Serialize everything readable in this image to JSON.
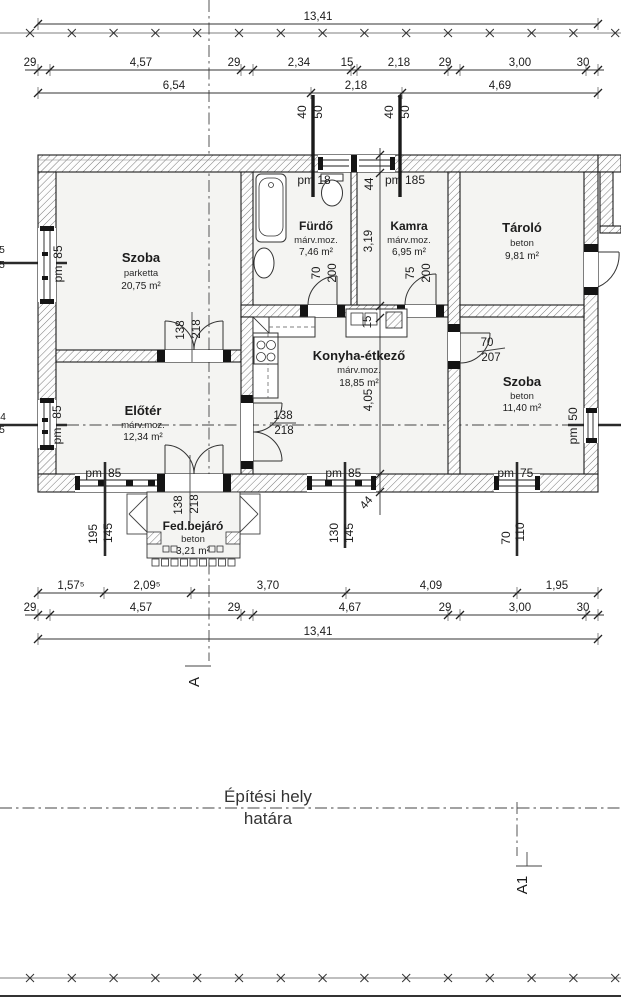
{
  "rooms": {
    "szoba1": {
      "name": "Szoba",
      "finish": "parketta",
      "area": "20,75 m²"
    },
    "furdo": {
      "name": "Fürdő",
      "finish": "márv.moz.",
      "area": "7,46 m²"
    },
    "kamra": {
      "name": "Kamra",
      "finish": "márv.moz.",
      "area": "6,95 m²"
    },
    "tarolo": {
      "name": "Tároló",
      "finish": "beton",
      "area": "9,81 m²"
    },
    "konyha": {
      "name": "Konyha-étkező",
      "finish": "márv.moz.",
      "area": "18,85 m²"
    },
    "szoba2": {
      "name": "Szoba",
      "finish": "beton",
      "area": "11,40 m²"
    },
    "eloter": {
      "name": "Előtér",
      "finish": "márv.moz.",
      "area": "12,34 m²"
    },
    "fedbejaro": {
      "name": "Fed.bejáró",
      "finish": "beton",
      "area": "3,21 m²"
    }
  },
  "dims": {
    "top1": "13,41",
    "top2": [
      "29",
      "4,57",
      "29",
      "2,34",
      "15",
      "2,18",
      "29",
      "3,00",
      "30"
    ],
    "top3": [
      "6,54",
      "2,18",
      "4,69"
    ],
    "bottom1": [
      "1,57⁵",
      "2,09⁵",
      "3,70",
      "4,09",
      "1,95"
    ],
    "bottom2": [
      "29",
      "4,57",
      "29",
      "4,67",
      "29",
      "3,00",
      "30"
    ],
    "bottom3": "13,41",
    "vertical": {
      "wall_top": "44",
      "furdo_depth": "3,19",
      "sink": "15",
      "konyha_depth": "4,05",
      "wall_bottom": "44"
    },
    "chimney_left": {
      "a": "40",
      "b": "50"
    },
    "chimney_right": {
      "a": "40",
      "b": "50"
    }
  },
  "windows": {
    "left_upper": {
      "prefix": "pm",
      "value": "85"
    },
    "left_lower": {
      "prefix": "pm",
      "value": "85"
    },
    "top_furdo": "pm 18",
    "top_kamra": "pm 185",
    "bottom_eloter": {
      "prefix": "pm",
      "value": "85",
      "dim_a": "195",
      "dim_b": "145"
    },
    "bottom_konyha": {
      "prefix": "pm",
      "value": "85",
      "dim_a": "130",
      "dim_b": "145"
    },
    "bottom_szoba2": {
      "prefix": "pm",
      "value": "75",
      "dim_a": "70",
      "dim_b": "110"
    },
    "right_szoba2": {
      "prefix": "pm",
      "value": "50"
    }
  },
  "doors": {
    "szoba1": {
      "w": "138",
      "h": "218"
    },
    "entrance": {
      "w": "138",
      "h": "218"
    },
    "eloter_konyha": {
      "w": "138",
      "h": "218"
    },
    "furdo": {
      "w": "70",
      "h": "200"
    },
    "kamra": {
      "w": "75",
      "h": "200"
    },
    "szoba2": {
      "w": "70",
      "h": "207"
    }
  },
  "sections": {
    "a": "A",
    "a1": "A1"
  },
  "site_boundary": {
    "line1": "Építési hely",
    "line2": "határa"
  },
  "edge_fragments": [
    "5",
    "5",
    "4",
    "5"
  ]
}
